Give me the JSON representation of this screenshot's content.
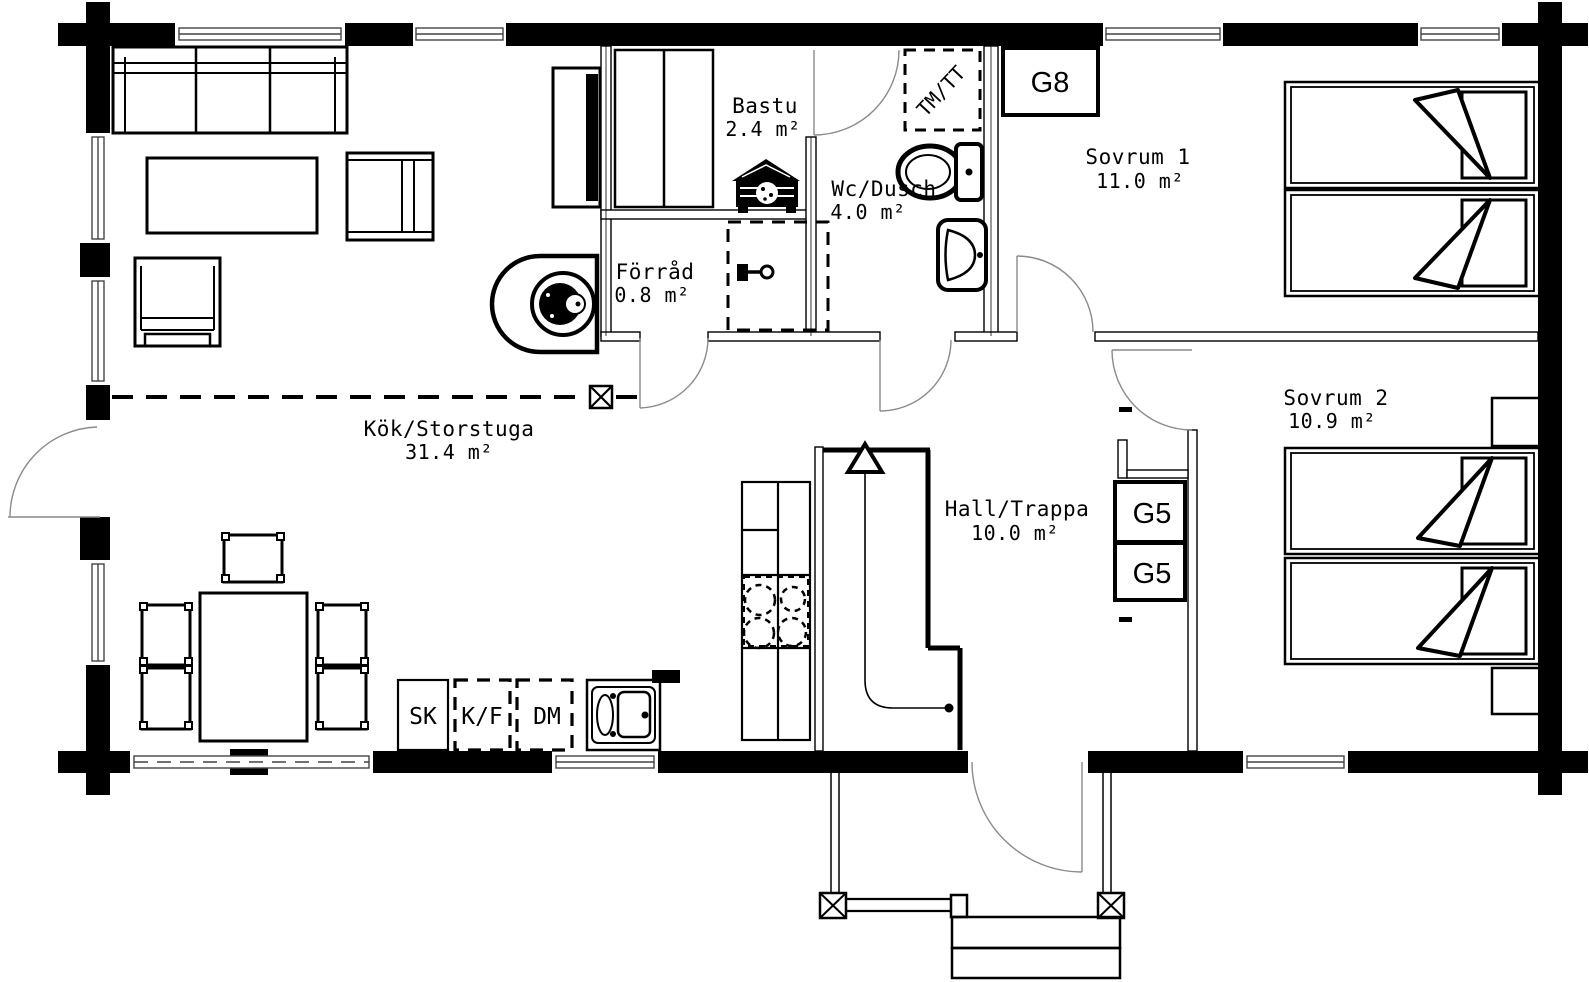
{
  "plan": {
    "rooms": {
      "kok": {
        "name": "Kök/Storstuga",
        "area": "31.4 m²"
      },
      "bastu": {
        "name": "Bastu",
        "area": "2.4 m²"
      },
      "forrad": {
        "name": "Förråd",
        "area": "0.8 m²"
      },
      "wc": {
        "name": "Wc/Dusch",
        "area": "4.0 m²"
      },
      "sovrum1": {
        "name": "Sovrum 1",
        "area": "11.0 m²"
      },
      "sovrum2": {
        "name": "Sovrum 2",
        "area": "10.9 m²"
      },
      "hall": {
        "name": "Hall/Trappa",
        "area": "10.0 m²"
      }
    },
    "closets": {
      "g8": "G8",
      "g5_upper": "G5",
      "g5_lower": "G5"
    },
    "appliances": {
      "tmtt": "TM/TT",
      "sk": "SK",
      "kf": "K/F",
      "dm": "DM"
    },
    "colors": {
      "ink": "#000000",
      "paper": "#ffffff",
      "swing": "#8a8a8a"
    }
  }
}
